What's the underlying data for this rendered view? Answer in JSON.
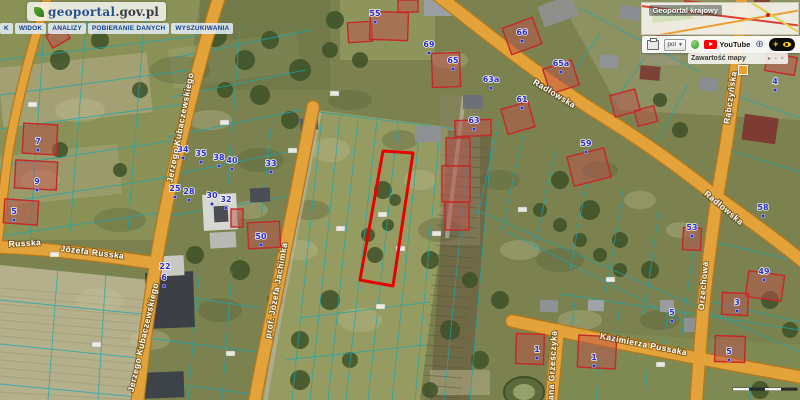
{
  "header": {
    "logo": {
      "main": "geoportal",
      "suffix": ".gov.pl"
    },
    "menu": [
      {
        "label": "K"
      },
      {
        "label": "WIDOK"
      },
      {
        "label": "ANALIZY"
      },
      {
        "label": "POBIERANIE DANYCH"
      },
      {
        "label": "WYSZUKIWANIA"
      }
    ]
  },
  "overlay": {
    "panel_title": "Geoportal krajowy",
    "toolbar": {
      "language": "pol",
      "youtube_label": "YouTube",
      "contrast_plus": "+"
    },
    "map_contents": {
      "title": "Zawartość mapy",
      "icons": "▸ ▫ ×"
    }
  },
  "map": {
    "highlight_parcel": {
      "points": "383,151 413,153 393,286 360,280",
      "color": "#e60000"
    },
    "street_labels": [
      {
        "text": "Jerzego Kubaczewskiego",
        "x": 183,
        "y": 128,
        "rot": -79,
        "size": 8.5
      },
      {
        "text": "Jerzego Kubaczewskiego",
        "x": 146,
        "y": 338,
        "rot": -77,
        "size": 8.5
      },
      {
        "text": "Russka",
        "x": 25,
        "y": 246,
        "rot": -3,
        "size": 8.5
      },
      {
        "text": "Józefa Russka",
        "x": 92,
        "y": 255,
        "rot": 7,
        "size": 8.5
      },
      {
        "text": "prof. Józefa Jachimka",
        "x": 279,
        "y": 291,
        "rot": -80,
        "size": 8.5
      },
      {
        "text": "Radłowska",
        "x": 553,
        "y": 96,
        "rot": 31,
        "size": 9
      },
      {
        "text": "Radłowska",
        "x": 722,
        "y": 210,
        "rot": 40,
        "size": 9
      },
      {
        "text": "Rąbczyńska",
        "x": 733,
        "y": 98,
        "rot": -82,
        "size": 8.5
      },
      {
        "text": "Orzechowa",
        "x": 706,
        "y": 286,
        "rot": -85,
        "size": 8.5
      },
      {
        "text": "Kazimierza Pussaka",
        "x": 643,
        "y": 347,
        "rot": 11,
        "size": 9
      },
      {
        "text": "Jana Grześczyka",
        "x": 555,
        "y": 368,
        "rot": -87,
        "size": 8.5
      }
    ],
    "house_numbers": [
      {
        "label": "55",
        "x": 375,
        "y": 13
      },
      {
        "label": "69",
        "x": 429,
        "y": 44
      },
      {
        "label": "65",
        "x": 453,
        "y": 60
      },
      {
        "label": "66",
        "x": 522,
        "y": 32
      },
      {
        "label": "65a",
        "x": 561,
        "y": 63
      },
      {
        "label": "63a",
        "x": 491,
        "y": 79
      },
      {
        "label": "61",
        "x": 522,
        "y": 99
      },
      {
        "label": "63",
        "x": 474,
        "y": 120
      },
      {
        "label": "59",
        "x": 586,
        "y": 143
      },
      {
        "label": "4",
        "x": 775,
        "y": 81
      },
      {
        "label": "58",
        "x": 763,
        "y": 207
      },
      {
        "label": "53",
        "x": 692,
        "y": 227
      },
      {
        "label": "49",
        "x": 764,
        "y": 271
      },
      {
        "label": "3",
        "x": 737,
        "y": 302
      },
      {
        "label": "5",
        "x": 729,
        "y": 351
      },
      {
        "label": "34",
        "x": 183,
        "y": 149
      },
      {
        "label": "35",
        "x": 201,
        "y": 153
      },
      {
        "label": "38",
        "x": 219,
        "y": 157
      },
      {
        "label": "40",
        "x": 232,
        "y": 160
      },
      {
        "label": "33",
        "x": 271,
        "y": 163
      },
      {
        "label": "25",
        "x": 175,
        "y": 188
      },
      {
        "label": "28",
        "x": 189,
        "y": 191
      },
      {
        "label": "30",
        "x": 212,
        "y": 195
      },
      {
        "label": "32",
        "x": 226,
        "y": 199
      },
      {
        "label": "50",
        "x": 261,
        "y": 236
      },
      {
        "label": "22",
        "x": 165,
        "y": 266
      },
      {
        "label": "6",
        "x": 164,
        "y": 277
      },
      {
        "label": "7",
        "x": 38,
        "y": 141
      },
      {
        "label": "9",
        "x": 37,
        "y": 181
      },
      {
        "label": "5",
        "x": 14,
        "y": 211
      },
      {
        "label": "1",
        "x": 537,
        "y": 349
      },
      {
        "label": "1",
        "x": 594,
        "y": 357
      },
      {
        "label": "5",
        "x": 672,
        "y": 312
      }
    ]
  },
  "colors": {
    "road": "#e3a23a",
    "road_border": "#b5791c",
    "parcel_line": "#1ba7b0",
    "building_outline": "#c62828",
    "house_number": "#2a2ecf",
    "highlight": "#e60000"
  }
}
